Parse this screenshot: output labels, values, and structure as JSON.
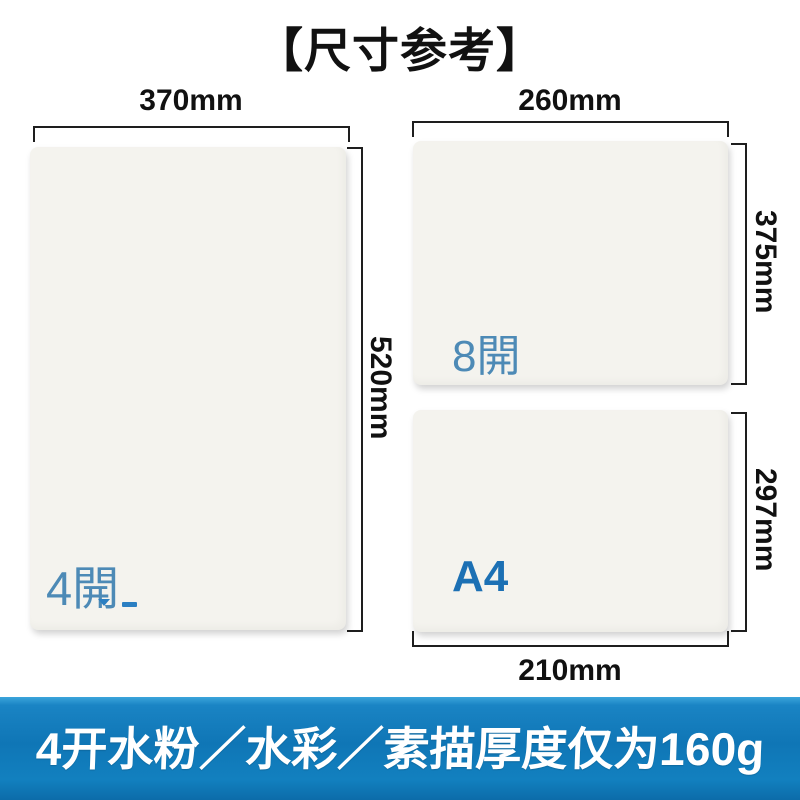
{
  "title": "【尺寸参考】",
  "sheets": [
    {
      "label": "4開",
      "width_label": "370mm",
      "height_label": "520mm"
    },
    {
      "label": "8開",
      "width_label": "260mm",
      "height_label": "375mm"
    },
    {
      "label": "A4",
      "width_label": "210mm",
      "height_label": "297mm"
    }
  ],
  "banner": {
    "text": "4开水粉／水彩／素描厚度仅为160g"
  },
  "colors": {
    "kai_label_blue": "#4d8ab6",
    "a4_label_blue": "#1c70b4",
    "banner_blue": "#0f76b6",
    "banner_blue_light": "#3ba5db",
    "sheet_background": "#f4f3ee",
    "dimension_line_black": "#1e1e1e",
    "banner_text_white": "#ffffff"
  }
}
